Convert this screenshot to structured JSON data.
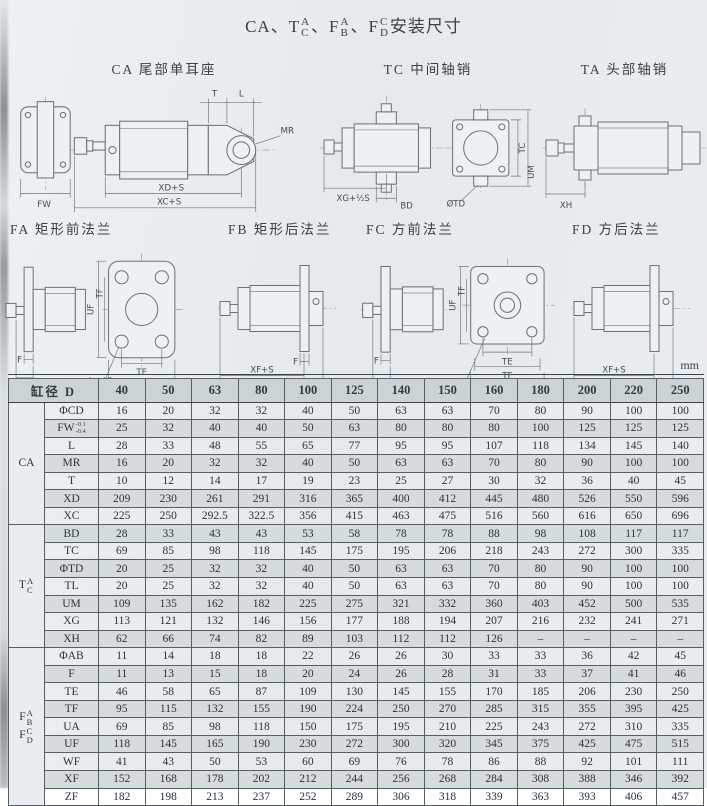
{
  "title": {
    "s1": "CA、T",
    "p1t": "A",
    "p1b": "C",
    "s2": "、F",
    "p2t": "A",
    "p2b": "B",
    "s3": "、F",
    "p3t": "C",
    "p3b": "D",
    "s4": "安装尺寸"
  },
  "diagrams": [
    {
      "id": "ca",
      "title": "CA 尾部单耳座",
      "dims": {
        "fw": "FW",
        "t": "T",
        "l": "L",
        "mr": "MR",
        "xd": "XD+S",
        "xc": "XC+S"
      }
    },
    {
      "id": "tc",
      "title": "TC 中间轴销",
      "dims": {
        "xg": "XG+½S",
        "bd": "BD",
        "td": "ØTD",
        "tc": "TC",
        "um": "UM"
      }
    },
    {
      "id": "ta",
      "title": "TA 头部轴销",
      "dims": {
        "xh": "XH"
      }
    },
    {
      "id": "fa",
      "title": "FA 矩形前法兰",
      "dims": {
        "f": "F",
        "wf": "WF",
        "ab": "4-ΦAB",
        "te": "TE",
        "ua": "UA",
        "uf": "UF",
        "tf": "TF"
      }
    },
    {
      "id": "fb",
      "title": "FB 矩形后法兰",
      "dims": {
        "f": "F",
        "xf": "XF+S",
        "zf": "ZF+S"
      }
    },
    {
      "id": "fc",
      "title": "FC 方前法兰",
      "dims": {
        "f": "F",
        "wf": "WF",
        "ab": "ØAB",
        "te": "TE",
        "tf": "TF",
        "uf": "UF"
      }
    },
    {
      "id": "fd",
      "title": "FD 方后法兰",
      "dims": {
        "xf": "XF+S",
        "zf": "ZF+S"
      }
    }
  ],
  "table": {
    "unit": "mm",
    "corner_label": "缸径",
    "corner_d": "D",
    "diameters": [
      "40",
      "50",
      "63",
      "80",
      "100",
      "125",
      "140",
      "150",
      "160",
      "180",
      "200",
      "220",
      "250"
    ],
    "groups": [
      {
        "parts": [
          {
            "main": "CA"
          }
        ],
        "rows": [
          {
            "dim": "ΦCD",
            "values": [
              "16",
              "20",
              "32",
              "32",
              "40",
              "50",
              "63",
              "63",
              "70",
              "80",
              "90",
              "100",
              "100"
            ]
          },
          {
            "dim": "FW",
            "tol": [
              "-0.1",
              "-0.4"
            ],
            "values": [
              "25",
              "32",
              "40",
              "40",
              "50",
              "63",
              "80",
              "80",
              "80",
              "100",
              "125",
              "125",
              "125"
            ]
          },
          {
            "dim": "L",
            "values": [
              "28",
              "33",
              "48",
              "55",
              "65",
              "77",
              "95",
              "95",
              "107",
              "118",
              "134",
              "145",
              "140"
            ]
          },
          {
            "dim": "MR",
            "values": [
              "16",
              "20",
              "32",
              "32",
              "40",
              "50",
              "63",
              "63",
              "70",
              "80",
              "90",
              "100",
              "100"
            ]
          },
          {
            "dim": "T",
            "values": [
              "10",
              "12",
              "14",
              "17",
              "19",
              "23",
              "25",
              "27",
              "30",
              "32",
              "36",
              "40",
              "45"
            ]
          },
          {
            "dim": "XD",
            "values": [
              "209",
              "230",
              "261",
              "291",
              "316",
              "365",
              "400",
              "412",
              "445",
              "480",
              "526",
              "550",
              "596"
            ]
          },
          {
            "dim": "XC",
            "values": [
              "225",
              "250",
              "292.5",
              "322.5",
              "356",
              "415",
              "463",
              "475",
              "516",
              "560",
              "616",
              "650",
              "696"
            ]
          }
        ]
      },
      {
        "parts": [
          {
            "main": "T",
            "stack": [
              "A",
              "C"
            ]
          }
        ],
        "rows": [
          {
            "dim": "BD",
            "values": [
              "28",
              "33",
              "43",
              "43",
              "53",
              "58",
              "78",
              "78",
              "88",
              "98",
              "108",
              "117",
              "117"
            ]
          },
          {
            "dim": "TC",
            "values": [
              "69",
              "85",
              "98",
              "118",
              "145",
              "175",
              "195",
              "206",
              "218",
              "243",
              "272",
              "300",
              "335"
            ]
          },
          {
            "dim": "ΦTD",
            "values": [
              "20",
              "25",
              "32",
              "32",
              "40",
              "50",
              "63",
              "63",
              "70",
              "80",
              "90",
              "100",
              "100"
            ]
          },
          {
            "dim": "TL",
            "values": [
              "20",
              "25",
              "32",
              "32",
              "40",
              "50",
              "63",
              "63",
              "70",
              "80",
              "90",
              "100",
              "100"
            ]
          },
          {
            "dim": "UM",
            "values": [
              "109",
              "135",
              "162",
              "182",
              "225",
              "275",
              "321",
              "332",
              "360",
              "403",
              "452",
              "500",
              "535"
            ]
          },
          {
            "dim": "XG",
            "values": [
              "113",
              "121",
              "132",
              "146",
              "156",
              "177",
              "188",
              "194",
              "207",
              "216",
              "232",
              "241",
              "271"
            ]
          },
          {
            "dim": "XH",
            "values": [
              "62",
              "66",
              "74",
              "82",
              "89",
              "103",
              "112",
              "112",
              "126",
              "–",
              "–",
              "–",
              "–"
            ]
          }
        ]
      },
      {
        "parts": [
          {
            "main": "F",
            "stack": [
              "A",
              "B"
            ]
          },
          {
            "main": "F",
            "stack": [
              "C",
              "D"
            ]
          }
        ],
        "rows": [
          {
            "dim": "ΦAB",
            "values": [
              "11",
              "14",
              "18",
              "18",
              "22",
              "26",
              "26",
              "30",
              "33",
              "33",
              "36",
              "42",
              "45"
            ]
          },
          {
            "dim": "F",
            "values": [
              "11",
              "13",
              "15",
              "18",
              "20",
              "24",
              "26",
              "28",
              "31",
              "33",
              "37",
              "41",
              "46"
            ]
          },
          {
            "dim": "TE",
            "values": [
              "46",
              "58",
              "65",
              "87",
              "109",
              "130",
              "145",
              "155",
              "170",
              "185",
              "206",
              "230",
              "250"
            ]
          },
          {
            "dim": "TF",
            "values": [
              "95",
              "115",
              "132",
              "155",
              "190",
              "224",
              "250",
              "270",
              "285",
              "315",
              "355",
              "395",
              "425"
            ]
          },
          {
            "dim": "UA",
            "values": [
              "69",
              "85",
              "98",
              "118",
              "150",
              "175",
              "195",
              "210",
              "225",
              "243",
              "272",
              "310",
              "335"
            ]
          },
          {
            "dim": "UF",
            "values": [
              "118",
              "145",
              "165",
              "190",
              "230",
              "272",
              "300",
              "320",
              "345",
              "375",
              "425",
              "475",
              "515"
            ]
          },
          {
            "dim": "WF",
            "values": [
              "41",
              "43",
              "50",
              "53",
              "60",
              "69",
              "76",
              "78",
              "86",
              "88",
              "92",
              "101",
              "111"
            ]
          },
          {
            "dim": "XF",
            "values": [
              "152",
              "168",
              "178",
              "202",
              "212",
              "244",
              "256",
              "268",
              "284",
              "308",
              "388",
              "346",
              "392"
            ]
          },
          {
            "dim": "ZF",
            "values": [
              "182",
              "198",
              "213",
              "237",
              "252",
              "289",
              "306",
              "318",
              "339",
              "363",
              "393",
              "406",
              "457"
            ]
          }
        ]
      }
    ]
  }
}
